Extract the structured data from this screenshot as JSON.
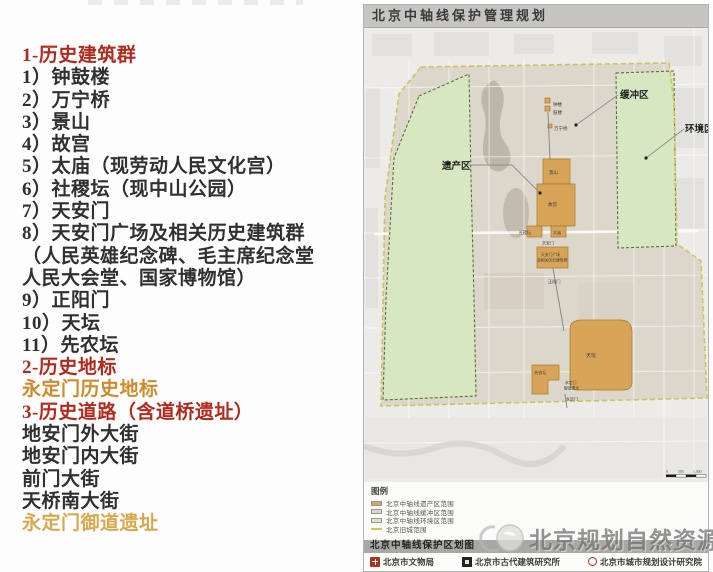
{
  "colors": {
    "heritage": "#d8a558",
    "buffer": "#dcd7cb",
    "environment": "#d7e7c2",
    "oldcity-line": "#cfc45a",
    "section_red": "#b22a1e",
    "landmark_orange": "#cf8a2a",
    "landmark_orange_light": "#d9a84e"
  },
  "left_list": {
    "lines": [
      {
        "text": "1-历史建筑群",
        "style": "header"
      },
      {
        "text": "1）钟鼓楼",
        "style": "item"
      },
      {
        "text": "2）万宁桥",
        "style": "item"
      },
      {
        "text": "3）景山",
        "style": "item"
      },
      {
        "text": "4）故宫",
        "style": "item"
      },
      {
        "text": "5）太庙（现劳动人民文化宫）",
        "style": "item"
      },
      {
        "text": "6）社稷坛（现中山公园）",
        "style": "item"
      },
      {
        "text": "7）天安门",
        "style": "item"
      },
      {
        "text": "8）天安门广场及相关历史建筑群",
        "style": "item"
      },
      {
        "text": "（人民英雄纪念碑、毛主席纪念堂",
        "style": "item"
      },
      {
        "text": "人民大会堂、国家博物馆）",
        "style": "item"
      },
      {
        "text": "9）正阳门",
        "style": "item"
      },
      {
        "text": "10）天坛",
        "style": "item"
      },
      {
        "text": "11）先农坛",
        "style": "item"
      },
      {
        "text": "2-历史地标",
        "style": "header"
      },
      {
        "text": "永定门历史地标",
        "style": "orange"
      },
      {
        "text": "3-历史道路（含道桥遗址）",
        "style": "header"
      },
      {
        "text": "地安门外大街",
        "style": "item"
      },
      {
        "text": "地安门内大街",
        "style": "item"
      },
      {
        "text": "前门大街",
        "style": "item"
      },
      {
        "text": "天桥南大街",
        "style": "item"
      },
      {
        "text": "永定门御道遗址",
        "style": "orange-light"
      }
    ]
  },
  "map_panel": {
    "title": "北京中轴线保护管理规划",
    "caption": "北京中轴线保护区划图",
    "legend": {
      "title": "图例",
      "items": [
        {
          "swatch": "heritage",
          "text": "北京中轴线遗产区范围"
        },
        {
          "swatch": "buffer",
          "text": "北京中轴线缓冲区范围"
        },
        {
          "swatch": "environment",
          "text": "北京中轴线环境区范围"
        },
        {
          "swatch": "oldcity-line",
          "text": "北京旧城范围"
        }
      ]
    },
    "credits": [
      {
        "icon": "seal-red",
        "text": "北京市文物局"
      },
      {
        "icon": "square-dark",
        "text": "北京市古代建筑研究所"
      },
      {
        "icon": "round-red",
        "text": "北京市城市规划设计研究院"
      }
    ],
    "map": {
      "zone_labels": [
        {
          "name": "zone-label-yichanqu",
          "text": "遗产区",
          "x": 78,
          "y": 141,
          "s": 9.5,
          "bold": true
        },
        {
          "name": "zone-label-huanchongqu",
          "text": "缓冲区",
          "x": 256,
          "y": 70,
          "s": 9.5,
          "bold": true
        },
        {
          "name": "zone-label-huanjingqu",
          "text": "环境区",
          "x": 321,
          "y": 104,
          "s": 9.5,
          "bold": true
        }
      ],
      "landmark_labels": [
        {
          "name": "label-zhonglou",
          "text": "钟楼",
          "x": 189,
          "y": 78,
          "s": 4.5
        },
        {
          "name": "label-gulou",
          "text": "鼓楼",
          "x": 189,
          "y": 86,
          "s": 4.5
        },
        {
          "name": "label-wanningqiao",
          "text": "万宁桥",
          "x": 190,
          "y": 102,
          "s": 4.5
        },
        {
          "name": "label-jingshan",
          "text": "景山",
          "x": 185,
          "y": 146,
          "s": 4.5
        },
        {
          "name": "label-gugong",
          "text": "故宫",
          "x": 184,
          "y": 178,
          "s": 4.5
        },
        {
          "name": "label-shejitan",
          "text": "社稷坛",
          "x": 155,
          "y": 206,
          "s": 4
        },
        {
          "name": "label-taimiao",
          "text": "太庙",
          "x": 189,
          "y": 206,
          "s": 4
        },
        {
          "name": "label-tiananmen",
          "text": "天安门",
          "x": 178,
          "y": 216.5,
          "s": 4
        },
        {
          "name": "label-guangchang-1",
          "text": "天安门广场",
          "x": 177,
          "y": 228,
          "s": 3.8
        },
        {
          "name": "label-guangchang-2",
          "text": "及相关历史建筑群",
          "x": 173,
          "y": 233.5,
          "s": 3.8
        },
        {
          "name": "label-zhengyangmen",
          "text": "正阳门",
          "x": 184,
          "y": 255,
          "s": 4.2
        },
        {
          "name": "label-tiantan",
          "text": "天坛",
          "x": 222,
          "y": 329,
          "s": 5
        },
        {
          "name": "label-xiannongtan",
          "text": "先农坛",
          "x": 170,
          "y": 346,
          "s": 4.2
        },
        {
          "name": "label-yudao-1",
          "text": "永定门",
          "x": 201,
          "y": 356,
          "s": 3.8
        },
        {
          "name": "label-yudao-2",
          "text": "御道遗址",
          "x": 200,
          "y": 361.5,
          "s": 3.8
        },
        {
          "name": "label-yongdingmen",
          "text": "永定门",
          "x": 202,
          "y": 372.5,
          "s": 4
        }
      ],
      "scale_labels": [
        {
          "name": "scale-0",
          "text": "0",
          "x": 302,
          "y": 445,
          "s": 3.8
        },
        {
          "name": "scale-500",
          "text": "500",
          "x": 314,
          "y": 445,
          "s": 3.8
        },
        {
          "name": "scale-1000",
          "text": "1,000",
          "x": 329,
          "y": 445,
          "s": 3.8
        }
      ]
    }
  },
  "watermark": {
    "text": "北京规划自然资源"
  }
}
